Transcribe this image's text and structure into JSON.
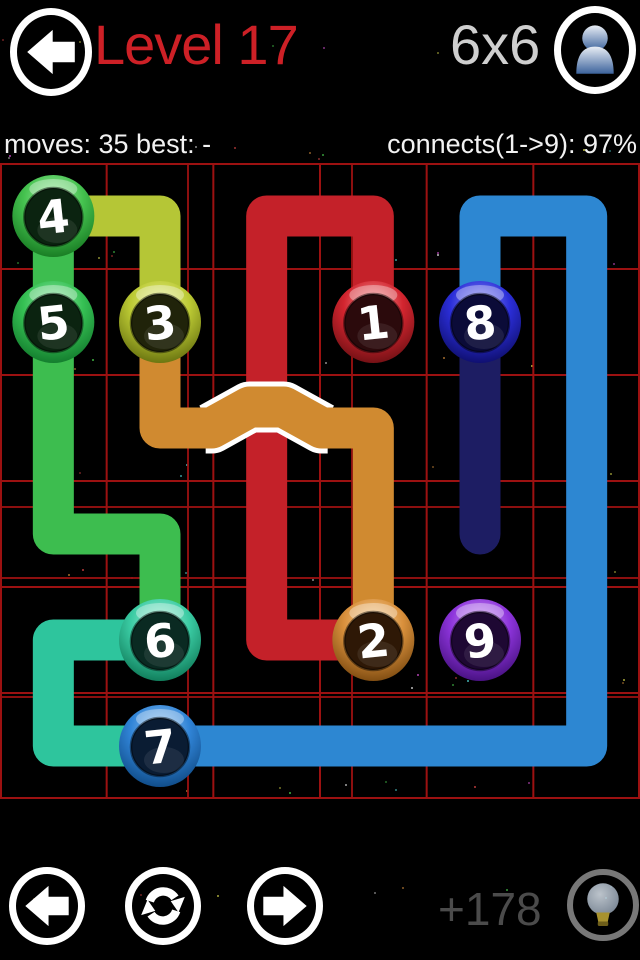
{
  "header": {
    "title": "Level 17",
    "title_color": "#cd2026",
    "grid_label": "6x6",
    "grid_label_color": "#cfcfcf"
  },
  "stats": {
    "left": "moves: 35 best: -",
    "right": "connects(1->9): 97%"
  },
  "footer": {
    "score": "+178"
  },
  "board": {
    "rows": 6,
    "cols": 6,
    "width": 640,
    "height": 636,
    "grid_color": "#9c1111",
    "extra_grid_lines": {
      "v": [
        188,
        352
      ],
      "h": [
        344,
        415,
        534
      ]
    },
    "pipe_width": 41,
    "bridge_outline_color": "#ffffff",
    "paths": [
      {
        "name": "link-1-2",
        "color": "#c42129",
        "waypoints": [
          [
            1,
            3
          ],
          [
            0,
            3
          ],
          [
            0,
            2
          ],
          [
            4,
            2
          ],
          [
            4,
            3
          ]
        ]
      },
      {
        "name": "link-2-3",
        "color": "#d08a30",
        "waypoints": [
          [
            1,
            1
          ],
          [
            2,
            1
          ],
          [
            2,
            3
          ],
          [
            4,
            3
          ]
        ],
        "bridge": {
          "col": 2,
          "rise": 21,
          "half_outer": 55,
          "half_inner": 17
        }
      },
      {
        "name": "link-3-4",
        "color": "#b5c636",
        "waypoints": [
          [
            1,
            1
          ],
          [
            0,
            1
          ],
          [
            0,
            0
          ]
        ]
      },
      {
        "name": "link-4-5",
        "color": "#3dbd4f",
        "waypoints": [
          [
            0,
            0
          ],
          [
            1,
            0
          ]
        ]
      },
      {
        "name": "link-5-6",
        "color": "#3dbd4f",
        "waypoints": [
          [
            1,
            0
          ],
          [
            3,
            0
          ],
          [
            3,
            1
          ],
          [
            4,
            1
          ]
        ]
      },
      {
        "name": "link-6-7",
        "color": "#2ec59d",
        "waypoints": [
          [
            4,
            1
          ],
          [
            4,
            0
          ],
          [
            5,
            0
          ],
          [
            5,
            1
          ]
        ]
      },
      {
        "name": "link-7-8",
        "color": "#2d87d2",
        "waypoints": [
          [
            5,
            1
          ],
          [
            5,
            5
          ],
          [
            0,
            5
          ],
          [
            0,
            4
          ],
          [
            1,
            4
          ]
        ]
      },
      {
        "name": "link-8-9-incomplete",
        "color": "#1d1d63",
        "waypoints": [
          [
            1,
            4
          ],
          [
            3,
            4
          ]
        ]
      }
    ],
    "dots": [
      {
        "label": "1",
        "row": 1,
        "col": 3,
        "ring": "#d3252f",
        "light": "#f4a0a0",
        "dark": "#701014",
        "inner": "#2b0a0c"
      },
      {
        "label": "2",
        "row": 4,
        "col": 3,
        "ring": "#d9903c",
        "light": "#f7d39c",
        "dark": "#7c4a10",
        "inner": "#2e1806"
      },
      {
        "label": "3",
        "row": 1,
        "col": 1,
        "ring": "#bcca34",
        "light": "#e9f195",
        "dark": "#67710f",
        "inner": "#20230a"
      },
      {
        "label": "4",
        "row": 0,
        "col": 0,
        "ring": "#45c24f",
        "light": "#aaeeaa",
        "dark": "#177a22",
        "inner": "#0b2310"
      },
      {
        "label": "5",
        "row": 1,
        "col": 0,
        "ring": "#36c154",
        "light": "#9ceab0",
        "dark": "#127a2c",
        "inner": "#0b2310"
      },
      {
        "label": "6",
        "row": 4,
        "col": 1,
        "ring": "#3acba3",
        "light": "#a8f0d8",
        "dark": "#0f7a58",
        "inner": "#0a2a22"
      },
      {
        "label": "7",
        "row": 5,
        "col": 1,
        "ring": "#3084d7",
        "light": "#9cc9f2",
        "dark": "#0f4a85",
        "inner": "#0a1c33"
      },
      {
        "label": "8",
        "row": 1,
        "col": 4,
        "ring": "#2b2ed9",
        "light": "#9398f5",
        "dark": "#0e0e6b",
        "inner": "#0b0b38"
      },
      {
        "label": "9",
        "row": 4,
        "col": 4,
        "ring": "#8d34db",
        "light": "#cf9ef6",
        "dark": "#45107e",
        "inner": "#1e0833"
      }
    ]
  }
}
